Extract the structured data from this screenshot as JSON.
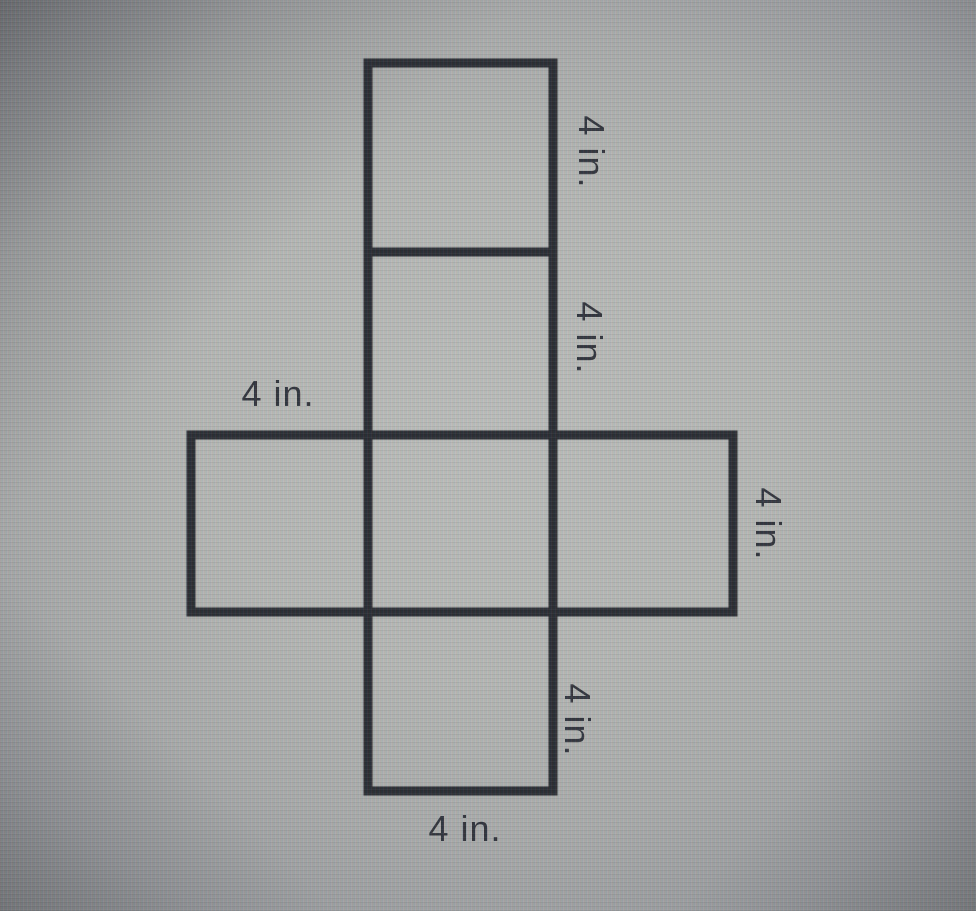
{
  "diagram": {
    "type": "geometry-net",
    "shape": "net of a cube (cross arrangement of 6 congruent squares)",
    "square_count": 6,
    "edge_length_value": 4,
    "edge_length_unit": "in.",
    "labels": {
      "top_square_right": "4 in.",
      "second_square_right": "4 in.",
      "left_square_top": "4 in.",
      "right_square_right": "4 in.",
      "bottom_square_right": "4 in.",
      "bottom_square_bottom": "4 in."
    },
    "colors": {
      "line": "#282b30",
      "text": "#30333a",
      "screen_background": "#b4b6b2"
    }
  }
}
